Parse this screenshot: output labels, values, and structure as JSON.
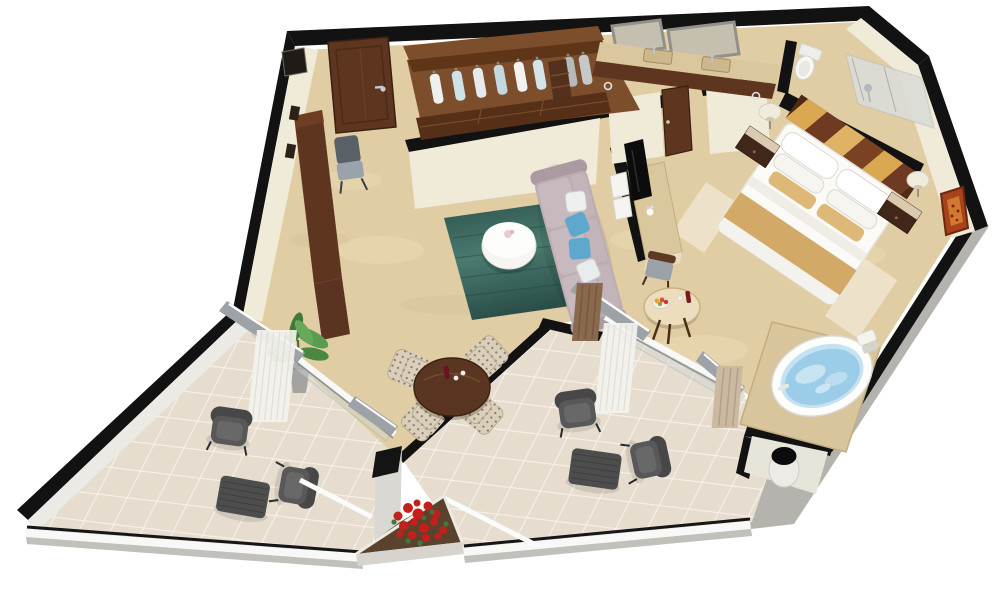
{
  "meta": {
    "title": "Isometric 3D floor plan render of a hotel suite",
    "canvas_width": 1000,
    "canvas_height": 609,
    "view": "cutaway isometric top-down 3D render on white background"
  },
  "palette": {
    "background": "#ffffff",
    "floor_marble": "#e0cda4",
    "floor_marble_light": "#f0e2bd",
    "floor_marble_vein": "#c9b185",
    "balcony_tile": "#e6ddcf",
    "tile_grout": "#f7f3ea",
    "wall_black": "#121212",
    "wall_face_cream": "#f0ead9",
    "exterior_wall_gray": "#b5b3ae",
    "wood_dark": "#5e3620",
    "wood_mid": "#7d4e2b",
    "marble_counter": "#dbc79e",
    "rug_teal_dark": "#2c544d",
    "rug_teal_light": "#4b7a6f",
    "sofa_mauve": "#bcadb2",
    "pillow_blue": "#5fa8cd",
    "bed_white": "#fbfaf7",
    "bed_runner_tan": "#d2a967",
    "headboard_tan": "#d9a851",
    "headboard_brown": "#6e3a22",
    "water_blue": "#9ccde8",
    "armchair_gray": "#585858",
    "plant_green": "#4a8842",
    "flower_red": "#c3201c",
    "railing_white": "#f8f8f6",
    "glass_frame_gray": "#9da2a6",
    "curtain_white": "#f3f2ee",
    "curtain_brown": "#8a6a4e",
    "artwork_rust": "#a8421c"
  },
  "objects": [
    "entry-door",
    "wardrobe-closet",
    "hanging-clothes",
    "closet-drawers",
    "bathroom-vanity",
    "double-sinks",
    "vanity-mirrors",
    "toilet",
    "glass-shower",
    "pocket-door",
    "king-bed",
    "striped-headboard",
    "nightstand",
    "table-lamp",
    "wall-art",
    "jacuzzi-tub",
    "tv-console",
    "television",
    "mini-shelves",
    "sofa",
    "blue-throw-pillows",
    "teal-area-rug",
    "round-coffee-table",
    "dining-table",
    "patterned-dining-chairs",
    "breakfast-table",
    "fruit-bowl",
    "desk-console",
    "desk-chair",
    "potted-plant",
    "sliding-glass-doors",
    "sheer-curtains",
    "balcony-armchair",
    "balcony-ottoman",
    "balcony-railing",
    "flower-planter",
    "red-flowers",
    "outdoor-column-bin"
  ]
}
